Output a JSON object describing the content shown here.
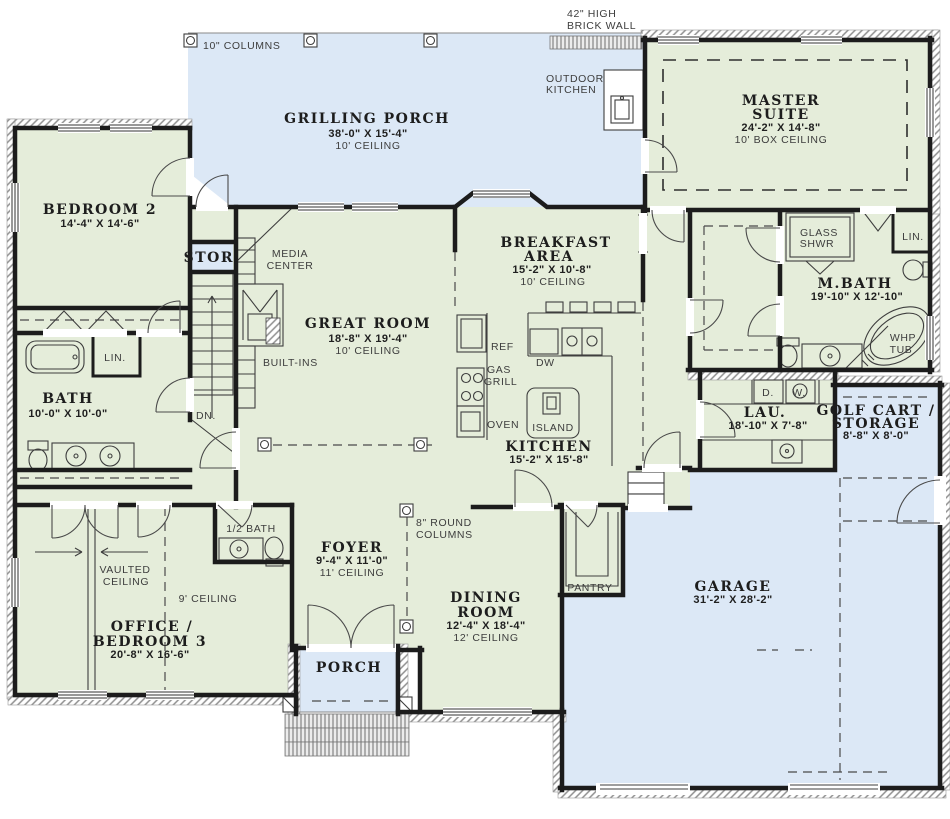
{
  "colors": {
    "room_fill": "#e5edda",
    "porch_fill": "#dce8f6",
    "wall": "#1c1c1c"
  },
  "rooms": {
    "grilling_porch": {
      "name": "GRILLING PORCH",
      "dims": "38'-0\" X 15'-4\"",
      "ceiling": "10' CEILING"
    },
    "master_suite": {
      "name1": "MASTER",
      "name2": "SUITE",
      "dims": "24'-2\" X 14'-8\"",
      "ceiling": "10' BOX CEILING"
    },
    "bedroom2": {
      "name": "BEDROOM 2",
      "dims": "14'-4\" X 14'-6\""
    },
    "great_room": {
      "name": "GREAT ROOM",
      "dims": "18'-8\" X 19'-4\"",
      "ceiling": "10' CEILING"
    },
    "breakfast": {
      "name1": "BREAKFAST",
      "name2": "AREA",
      "dims": "15'-2\" X 10'-8\"",
      "ceiling": "10' CEILING"
    },
    "mbath": {
      "name": "M.BATH",
      "dims": "19'-10\" X 12'-10\""
    },
    "kitchen": {
      "name": "KITCHEN",
      "dims": "15'-2\" X 15'-8\""
    },
    "bath": {
      "name": "BATH",
      "dims": "10'-0\" X 10'-0\""
    },
    "laundry": {
      "name": "LAU.",
      "dims": "18'-10\" X 7'-8\""
    },
    "golf_cart": {
      "name1": "GOLF CART /",
      "name2": "STORAGE",
      "dims": "8'-8\" X 8'-0\""
    },
    "half_bath": {
      "name": "1/2 BATH"
    },
    "office": {
      "name1": "OFFICE /",
      "name2": "BEDROOM 3",
      "dims": "20'-8\" X 16'-6\""
    },
    "foyer": {
      "name": "FOYER",
      "dims": "9'-4\" X 11'-0\"",
      "ceiling": "11' CEILING"
    },
    "dining": {
      "name1": "DINING",
      "name2": "ROOM",
      "dims": "12'-4\" X 18'-4\"",
      "ceiling": "12' CEILING"
    },
    "porch": {
      "name": "PORCH"
    },
    "garage": {
      "name": "GARAGE",
      "dims": "31'-2\" X 28'-2\""
    },
    "stor": {
      "name": "STOR."
    }
  },
  "labels": {
    "brick1": "42\" HIGH",
    "brick2": "BRICK WALL",
    "columns10": "10\" COLUMNS",
    "outdoor1": "OUTDOOR",
    "outdoor2": "KITCHEN",
    "media1": "MEDIA",
    "media2": "CENTER",
    "builtins": "BUILT-INS",
    "dn": "DN.",
    "lin_bath": "LIN.",
    "lin_mbath": "LIN.",
    "glass1": "GLASS",
    "glass2": "SHWR",
    "whp1": "WHP",
    "whp2": "TUB",
    "ref": "REF",
    "gas": "GAS",
    "grill": "GRILL",
    "oven": "OVEN",
    "dw": "DW",
    "island": "ISLAND",
    "dryer": "D.",
    "washer": "W.",
    "pantry": "PANTRY",
    "rcol1": "8\" ROUND",
    "rcol2": "COLUMNS",
    "vault1": "VAULTED",
    "vault2": "CEILING",
    "ceiling9": "9' CEILING"
  }
}
